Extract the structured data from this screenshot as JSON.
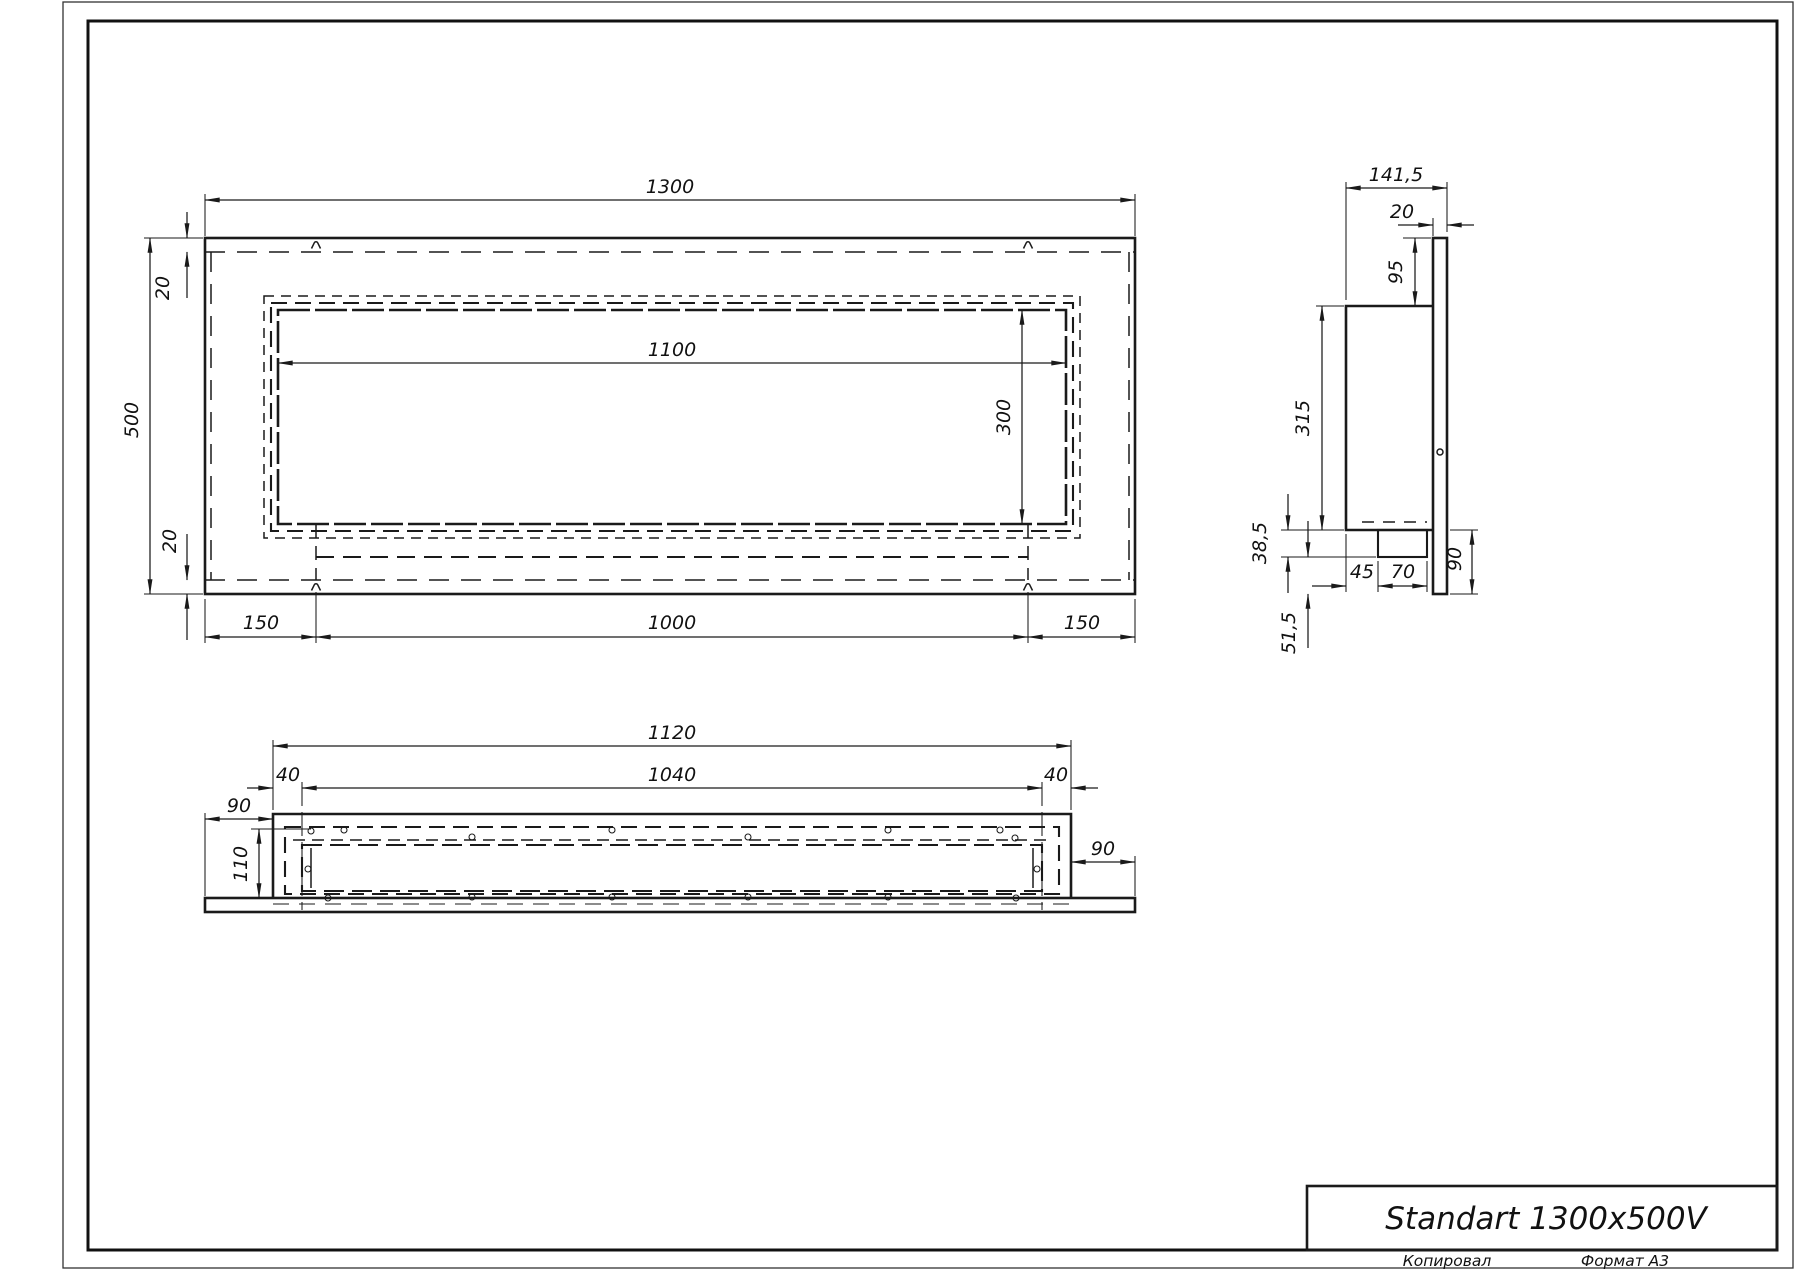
{
  "title_block": {
    "model": "Standart 1300x500V",
    "copied_by_label": "Копировал",
    "format_label": "Формат А3"
  },
  "front_view": {
    "dim_width": "1300",
    "dim_height": "500",
    "dim_top_offset": "20",
    "dim_bottom_offset": "20",
    "dim_opening_width": "1100",
    "dim_opening_height": "300",
    "dim_mount_left": "150",
    "dim_mount_span": "1000",
    "dim_mount_right": "150"
  },
  "side_view": {
    "dim_depth": "141,5",
    "dim_flange_thickness": "20",
    "dim_top_inset": "95",
    "dim_body_height": "315",
    "dim_bracket_drop": "38,5",
    "dim_bottom_clearance": "51,5",
    "dim_lower_height": "90",
    "dim_bracket_offset": "45",
    "dim_bracket_width": "70"
  },
  "bottom_view": {
    "dim_body_width": "1120",
    "dim_tray_width": "1040",
    "dim_left_inset": "40",
    "dim_right_inset": "40",
    "dim_left_margin": "90",
    "dim_right_margin": "90",
    "dim_depth": "110"
  }
}
